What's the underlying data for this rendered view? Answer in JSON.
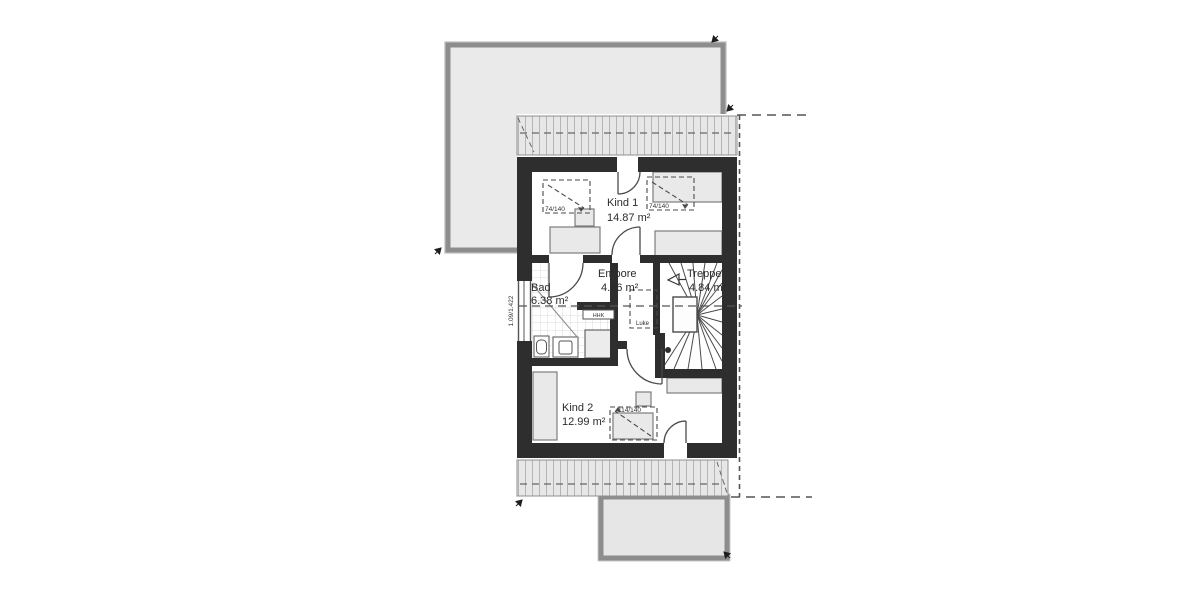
{
  "floorplan": {
    "rooms": [
      {
        "id": "kind1",
        "name": "Kind 1",
        "area": "14.87 m²"
      },
      {
        "id": "empore",
        "name": "Empore",
        "area": "4.66 m²"
      },
      {
        "id": "treppe",
        "name": "Treppe",
        "area": "4.84 m²"
      },
      {
        "id": "bad",
        "name": "Bad",
        "area": "6.38 m²"
      },
      {
        "id": "kind2",
        "name": "Kind 2",
        "area": "12.99 m²"
      }
    ],
    "labels": {
      "roof_window_1": "74/140",
      "roof_window_2": "74/140",
      "roof_window_3": "114/140",
      "wall_window": "1.09/1.422",
      "attic_hatch": "Luke",
      "radiator": "HHK"
    },
    "colors": {
      "wall": "#2e2e2e",
      "roof_fill": "#e9e9e9",
      "roof_border": "#8d8d8d",
      "hatch_line": "#b5b5b5",
      "drawing_line": "#4a4a4a"
    }
  }
}
